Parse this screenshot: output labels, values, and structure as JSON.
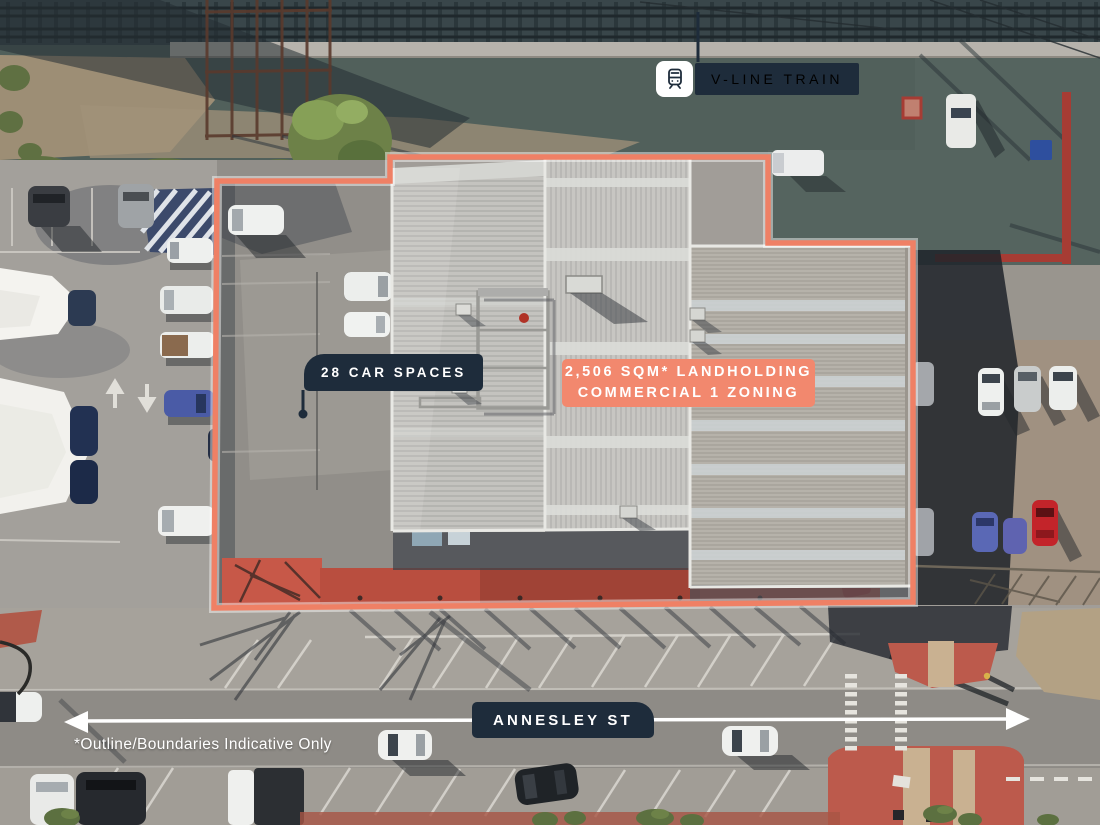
{
  "annotations": {
    "vline": {
      "text": "V-LINE TRAIN",
      "icon": "train-icon"
    },
    "car_spaces": {
      "text": "28 CAR SPACES"
    },
    "landholding": {
      "line1": "2,506 SQM* LANDHOLDING",
      "line2": "COMMERCIAL 1 ZONING"
    },
    "street": {
      "text": "ANNESLEY ST",
      "direction_arrow": "double-headed-horizontal"
    },
    "disclaimer": {
      "text": "*Outline/Boundaries Indicative Only"
    }
  },
  "colors": {
    "accent_coral": "#F2886E",
    "boundary_coral": "#EF8065",
    "label_navy": "#1E2C3B",
    "text_white": "#FFFFFF"
  }
}
